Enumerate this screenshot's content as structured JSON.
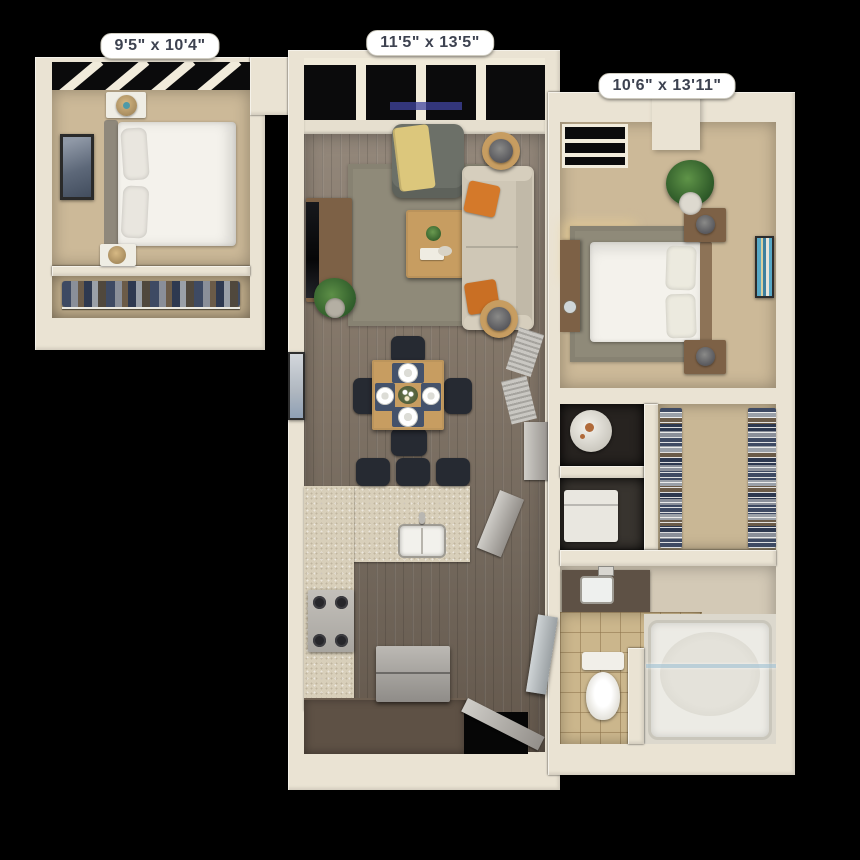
{
  "floorplan": {
    "background": "#000000",
    "dimension_labels": [
      {
        "room": "bedroom-1",
        "text": "9'5\" x 10'4\""
      },
      {
        "room": "living-room",
        "text": "11'5\" x 13'5\""
      },
      {
        "room": "bedroom-2",
        "text": "10'6\" x 13'11\""
      }
    ],
    "colors": {
      "background": "#000000",
      "wall": "#eae3d3",
      "floor_wood": "#877a6c",
      "carpet": "#ccb998",
      "rug": "#8f8a79",
      "counter": "#d8cfba",
      "cabinet": "#5e5145",
      "sofa": "#cfc7b6",
      "armchair": "#6c7068",
      "pillow_accent": "#d4792a",
      "throw_blanket": "#dcc77c",
      "table_wood": "#c79d61",
      "wood_furniture": "#7d6146",
      "placemat": "#44526b",
      "chair": "#262a32",
      "bedding": "#f4f2ec",
      "tile": "#cbb68c",
      "window_glass": "#0b0b0c",
      "label_bg": "#ffffff",
      "label_text": "#3d4250"
    }
  }
}
